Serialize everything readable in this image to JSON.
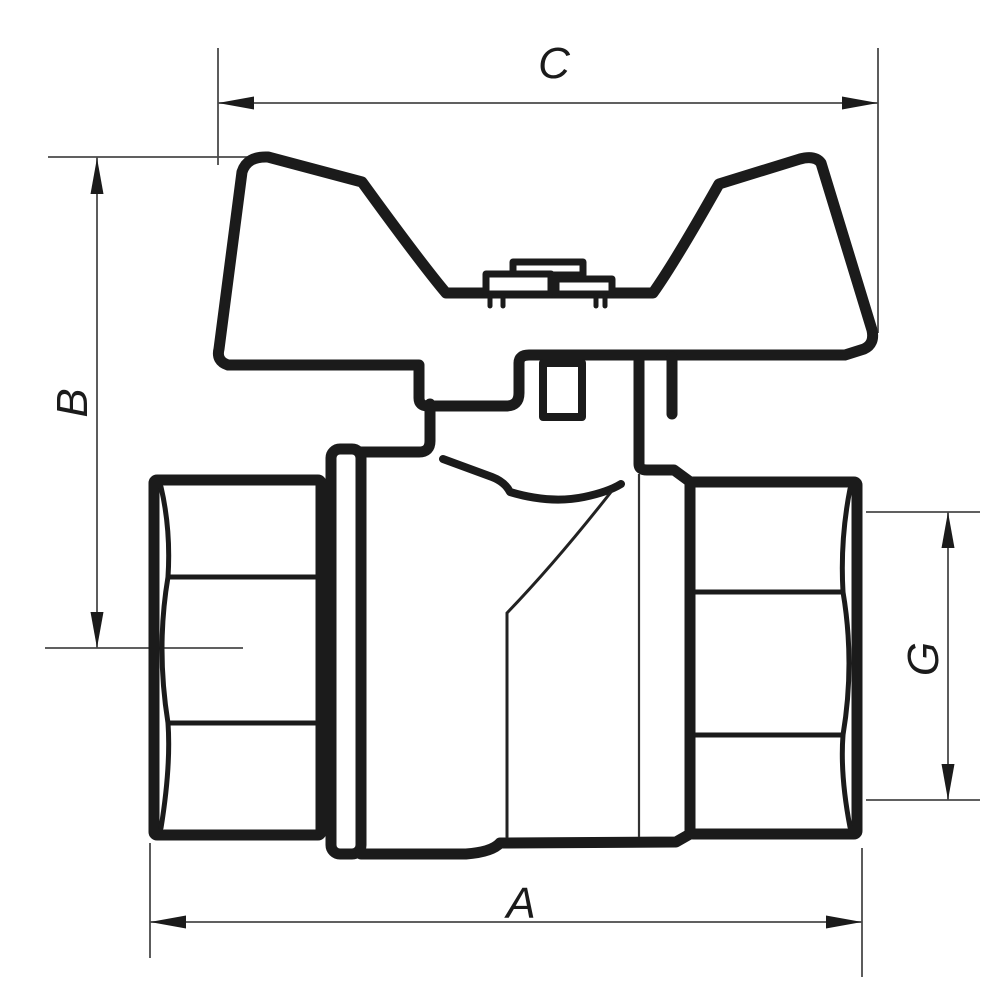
{
  "drawing": {
    "title": "Ball valve with butterfly handle - dimensioned side view",
    "type": "technical line drawing",
    "background_color": "#ffffff",
    "outline_color": "#1b1b1b",
    "dimension_line_color": "#4a4a4a"
  },
  "labels": {
    "top_width": "C",
    "left_height": "B",
    "bottom_width": "A",
    "right_thread": "G"
  }
}
